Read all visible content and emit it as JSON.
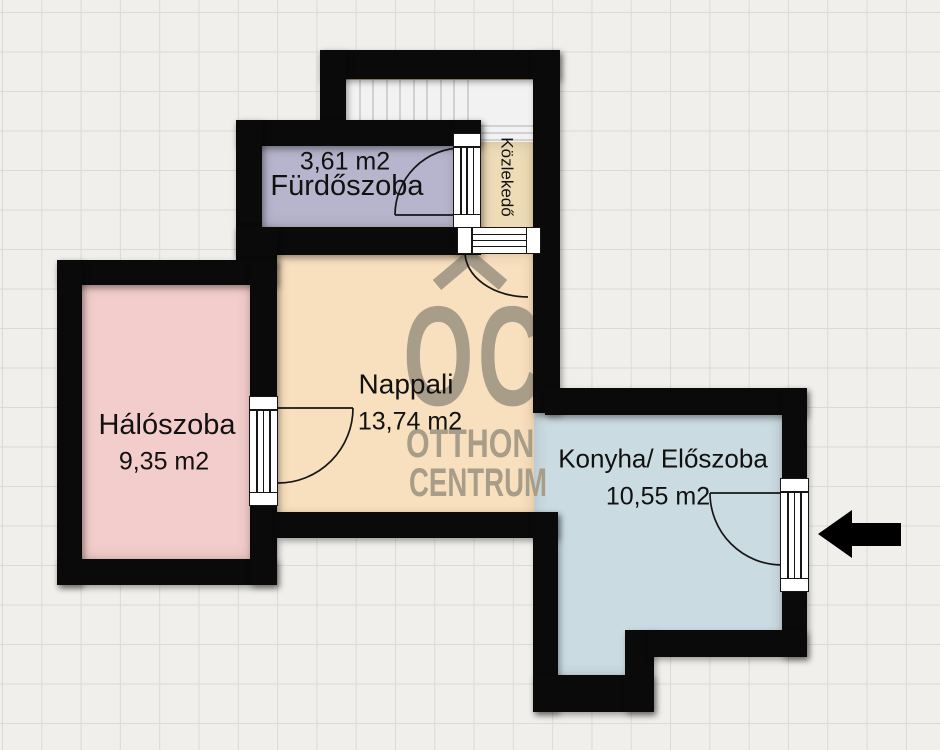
{
  "plan": {
    "title": "floor-plan",
    "rooms": [
      {
        "id": "furdoszoba",
        "label": "Fürdőszoba",
        "area": "3,61 m2",
        "color": "#b6b5cd"
      },
      {
        "id": "haloszoba",
        "label": "Hálószoba",
        "area": "9,35 m2",
        "color": "#f3cdcb"
      },
      {
        "id": "nappali",
        "label": "Nappali",
        "area": "13,74 m2",
        "color": "#f8dfbe"
      },
      {
        "id": "konyha",
        "label": "Konyha/ Előszoba",
        "area": "10,55 m2",
        "color": "#cadbe2"
      },
      {
        "id": "kozlekedo",
        "label": "Közlekedő",
        "area": "",
        "color": "#eedcb7"
      }
    ],
    "watermark": {
      "initials": "OC",
      "line1": "OTTHON",
      "line2": "CENTRUM",
      "color": "#a89d89"
    },
    "colors": {
      "wall": "#0a0a0a",
      "background": "#f1efec",
      "grid_line": "#dcdad5",
      "stair": "#f2f2f2",
      "stair_line": "#c6c6c6",
      "stair_edge": "#b3a383",
      "arrow": "#000000",
      "door_line": "#161616",
      "text": "#111111",
      "watermark": "#a89d89"
    }
  }
}
